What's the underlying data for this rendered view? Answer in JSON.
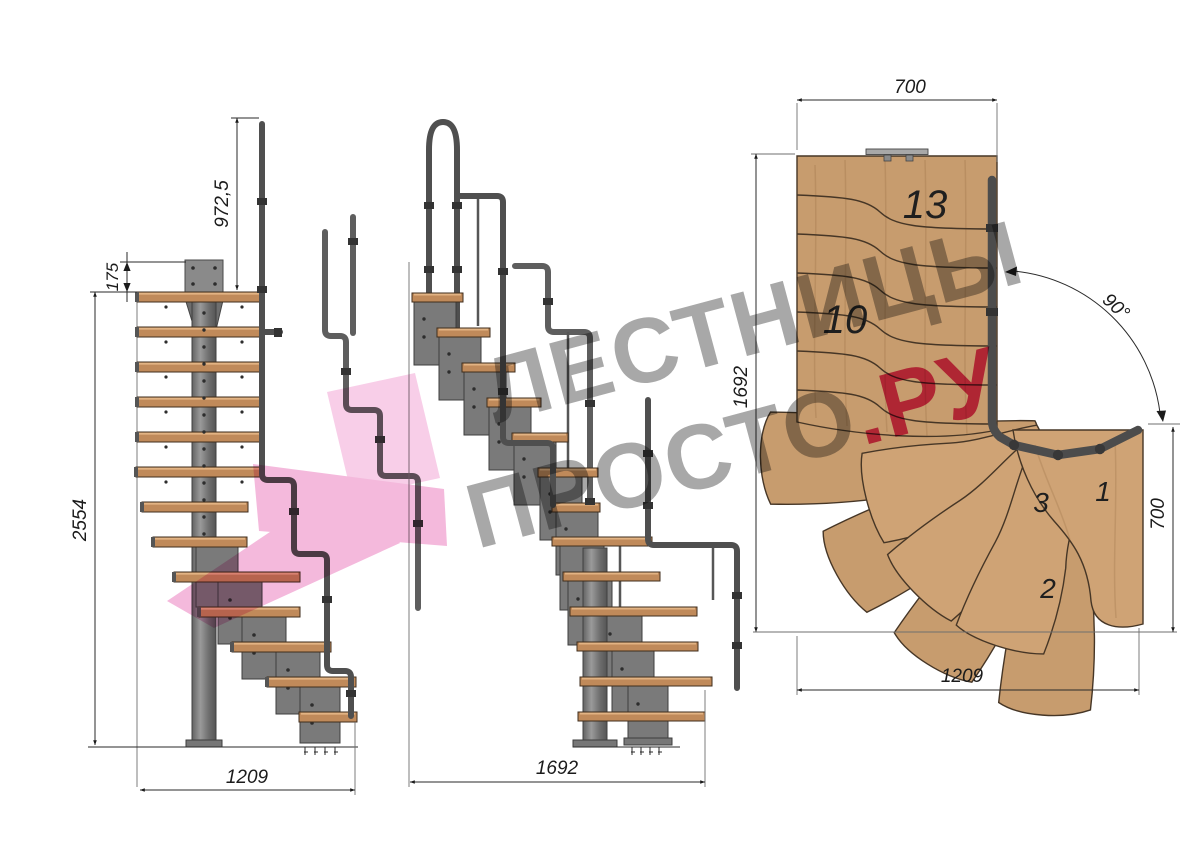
{
  "drawing": {
    "type": "staircase technical drawing, three views",
    "views": {
      "side": {
        "name": "side elevation",
        "dims": {
          "rail_height": "972,5",
          "top_landing": "175",
          "total_height": "2554",
          "run_length": "1209"
        }
      },
      "front": {
        "name": "front elevation",
        "dims": {
          "run_length": "1692"
        }
      },
      "plan": {
        "name": "top plan view",
        "dims": {
          "top_width": "700",
          "left_length": "1692",
          "turn_angle": "90°",
          "right_width": "700",
          "bottom_length": "1209"
        },
        "steps": {
          "s13": "13",
          "s10": "10",
          "s3": "3",
          "s1": "1",
          "s2": "2"
        }
      }
    },
    "watermark": {
      "line1": "ЛЕСТНИЦЫ",
      "line2": "ПРОСТО",
      "line2_accent": ".РУ"
    },
    "colors": {
      "wood": "#c08a5a",
      "plan_wood": "#c79c6e",
      "steel": "#7a7a7a",
      "rail": "#4f4f4f",
      "dimension": "#1b1b1b",
      "watermark_gray": "#a8a8a8",
      "watermark_pink": "#e03d76",
      "logo_pink": "#f2a8d4"
    }
  }
}
